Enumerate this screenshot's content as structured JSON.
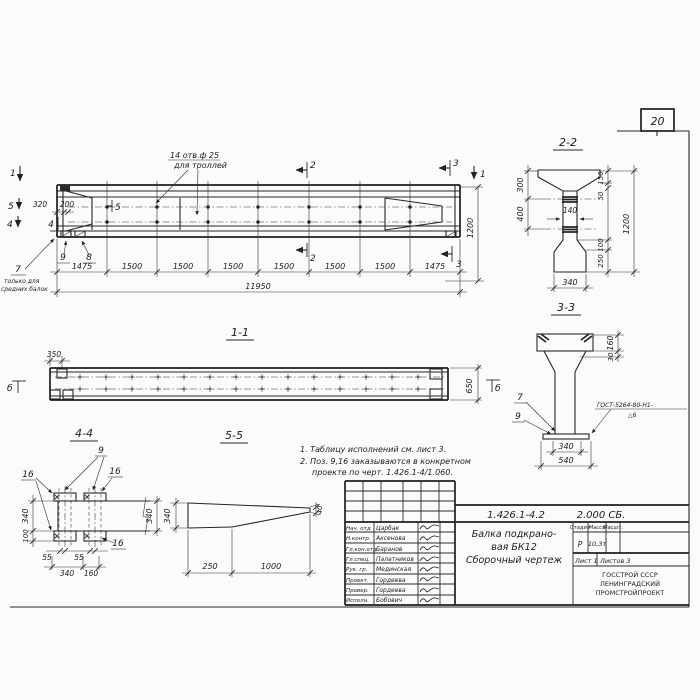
{
  "page": {
    "number": "20"
  },
  "plan_view": {
    "hole_note_1": "14 отв.ф 25",
    "hole_note_2": "для троллей",
    "pos7_note_1": "только для",
    "pos7_note_2": "средних балок",
    "dim_320": "320",
    "dim_200": "200",
    "dim_1200": "1200",
    "dim_total": "11950",
    "chain": [
      "1475",
      "1500",
      "1500",
      "1500",
      "1500",
      "1500",
      "1500",
      "1475"
    ],
    "mark_1_left": "1",
    "mark_1_right": "1",
    "mark_2_top": "2",
    "mark_2_bottom": "2",
    "mark_3_top": "3",
    "mark_3_bottom": "3",
    "mark_4_side": "4",
    "mark_5_side": "5",
    "mark_4_in": "4",
    "mark_5_in": "5",
    "pos_7": "7",
    "pos_8": "8",
    "pos_9": "9"
  },
  "view_11": {
    "title": "1-1",
    "dim_350": "350",
    "dim_650": "650",
    "mark_b_left": "б",
    "mark_b_right": "б"
  },
  "sec_22": {
    "title": "2-2",
    "dim_300": "300",
    "dim_400": "400",
    "dim_140": "140",
    "dim_150": "150",
    "dim_50": "50",
    "dim_1200": "1200",
    "dim_100": "100",
    "dim_250": "250",
    "dim_340": "340"
  },
  "sec_33": {
    "title": "3-3",
    "dim_160": "160",
    "dim_30": "30",
    "dim_340": "340",
    "dim_540": "540",
    "pos_7": "7",
    "pos_9": "9",
    "weld_line_1": "ГОСТ-5264-80-Н1-",
    "weld_line_2": "△6"
  },
  "det_44": {
    "title": "4-4",
    "pos_9": "9",
    "pos_16_left": "16",
    "pos_16_right": "16",
    "pos_16_bottom": "16",
    "dim_340_left": "340",
    "dim_100": "100",
    "dim_55_a": "55",
    "dim_55_b": "55",
    "dim_340_bottom": "340",
    "dim_160": "160",
    "dim_340_right": "340"
  },
  "det_55": {
    "title": "5-5",
    "dim_340": "340",
    "dim_250": "250",
    "dim_1000": "1000",
    "dim_40": "40"
  },
  "notes": {
    "line_1": "1. Таблицу исполнений см. лист 3.",
    "line_2": "2. Поз. 9,16 заказываются в конкретном",
    "line_3": "проекте по черт. 1.426.1-4/1.060."
  },
  "title_block": {
    "doc_number": "1.426.1-4.2",
    "doc_code": "2.000 СБ.",
    "title_1": "Балка подкрано-",
    "title_2": "вая БК12",
    "title_3": "Сборочный чертеж",
    "col_stage": "Стадия",
    "col_mass": "Масса",
    "col_scale": "Масшт.",
    "stage": "Р",
    "mass": "10,3т",
    "sheet": "Лист 1",
    "sheets": "Листов 3",
    "org_1": "ГОССТРОЙ СССР",
    "org_2": "ЛЕНИНГРАДСКИЙ",
    "org_3": "ПРОМСТРОЙПРОЕКТ",
    "rows": [
      {
        "role": "Нач. отд",
        "name": "Царбак"
      },
      {
        "role": "Н.контр.",
        "name": "Аксенова"
      },
      {
        "role": "Гл.кон.отд",
        "name": "Баранов"
      },
      {
        "role": "Гл.спец.",
        "name": "Палатников"
      },
      {
        "role": "Рук. гр.",
        "name": "Мединская"
      },
      {
        "role": "Проект.",
        "name": "Гордеева"
      },
      {
        "role": "Провер.",
        "name": "Гордеева"
      },
      {
        "role": "Исполн.",
        "name": "Бобович"
      }
    ]
  }
}
